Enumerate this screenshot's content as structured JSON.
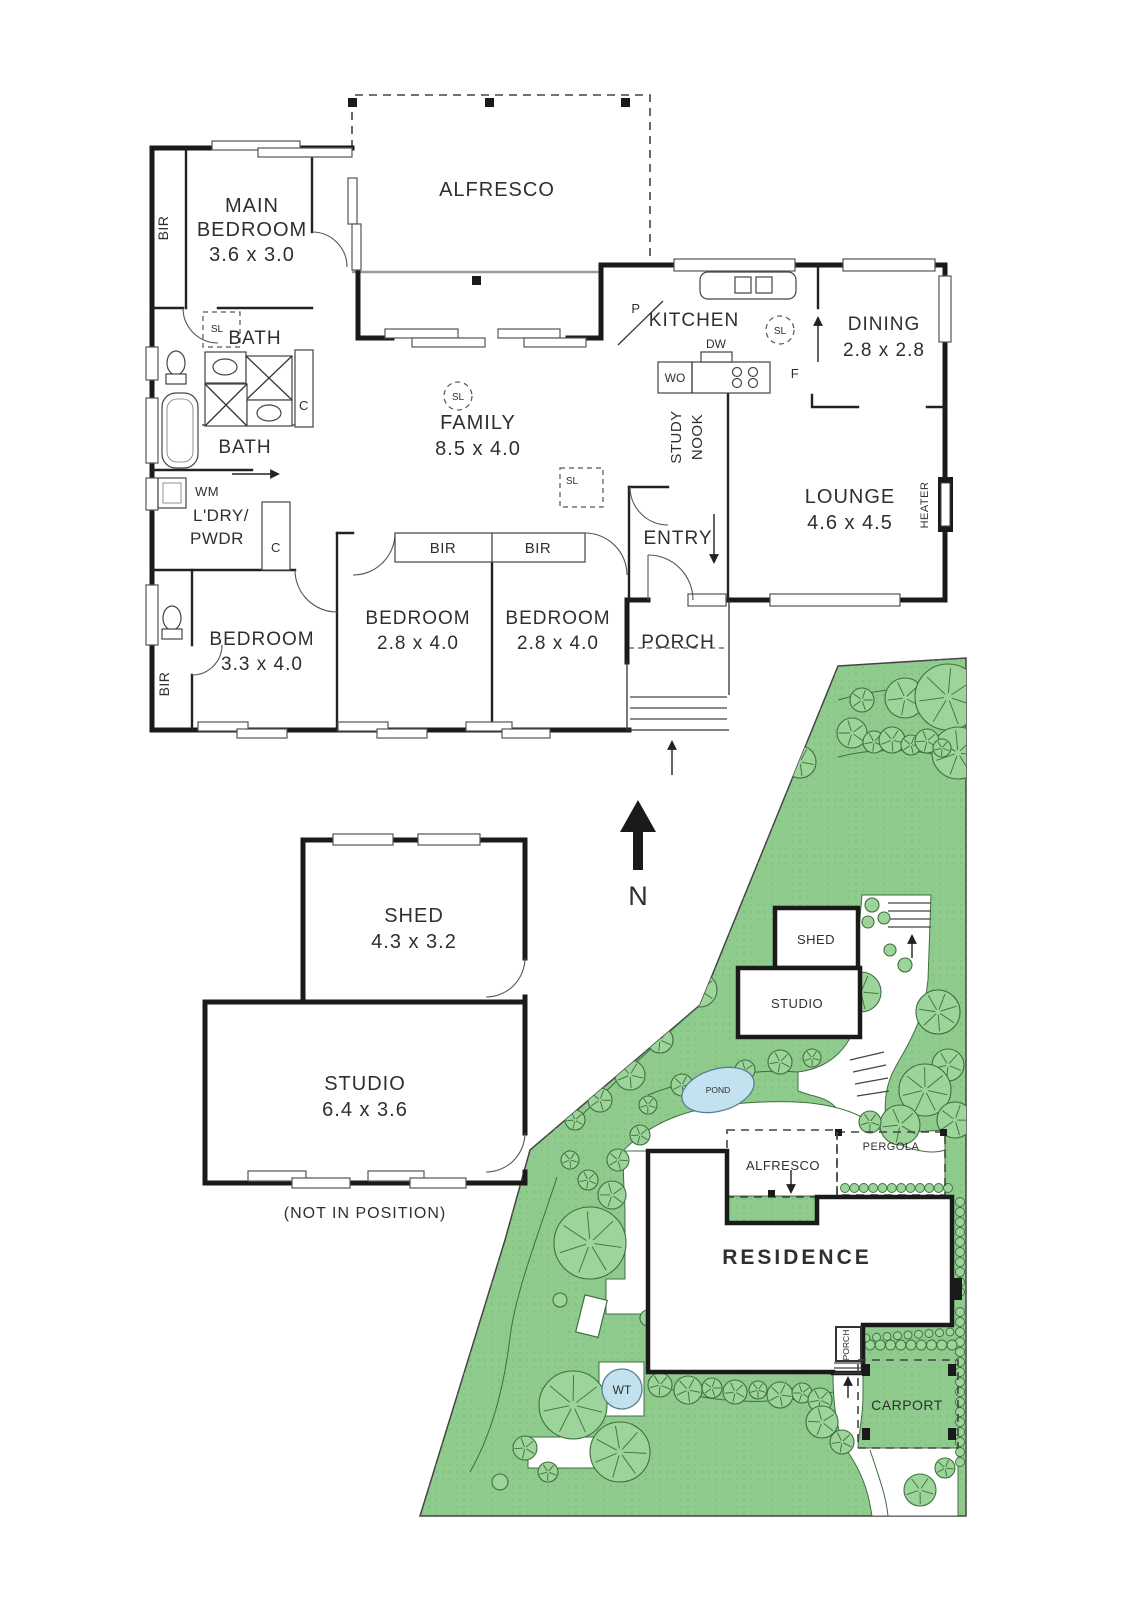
{
  "colors": {
    "grass": "#8ecb8d",
    "grass_dot": "#7ab578",
    "tree_fill": "#9cd49a",
    "tree_stroke": "#3f6f3f",
    "pond": "#c3e2f0",
    "wall": "#1a1a1a",
    "text": "#2f2f2f"
  },
  "house": {
    "bir_top": "BIR",
    "main_bedroom_1": "MAIN",
    "main_bedroom_2": "BEDROOM",
    "main_bedroom_dims": "3.6 x 3.0",
    "alfresco": "ALFRESCO",
    "sl_bath": "SL",
    "bath_1": "BATH",
    "c_bath": "C",
    "bath_2": "BATH",
    "wm": "WM",
    "ldry_1": "L'DRY/",
    "ldry_2": "PWDR",
    "c_laundry": "C",
    "family": "FAMILY",
    "family_dims": "8.5 x 4.0",
    "sl_family": "SL",
    "sl_family_sq": "SL",
    "kitchen": "KITCHEN",
    "pantry": "P",
    "sl_kitchen": "SL",
    "dw": "DW",
    "wo": "WO",
    "fridge": "F",
    "dining": "DINING",
    "dining_dims": "2.8 x 2.8",
    "study_nook_1": "STUDY",
    "study_nook_2": "NOOK",
    "lounge": "LOUNGE",
    "lounge_dims": "4.6 x 4.5",
    "heater": "HEATER",
    "entry": "ENTRY",
    "bir_hall_1": "BIR",
    "bir_hall_2": "BIR",
    "bedroom1": "BEDROOM",
    "bedroom1_dims": "3.3 x 4.0",
    "bedroom2": "BEDROOM",
    "bedroom2_dims": "2.8 x 4.0",
    "bedroom3": "BEDROOM",
    "bedroom3_dims": "2.8 x 4.0",
    "porch": "PORCH",
    "bir_bottom": "BIR"
  },
  "outbuilding": {
    "shed": "SHED",
    "shed_dims": "4.3 x 3.2",
    "studio": "STUDIO",
    "studio_dims": "6.4 x 3.6",
    "note": "(NOT IN POSITION)"
  },
  "compass": {
    "north": "N"
  },
  "site": {
    "shed": "SHED",
    "studio": "STUDIO",
    "pond": "POND",
    "alfresco": "ALFRESCO",
    "pergola": "PERGOLA",
    "residence": "RESIDENCE",
    "porch": "PORCH",
    "water_tank": "WT",
    "carport": "CARPORT"
  }
}
